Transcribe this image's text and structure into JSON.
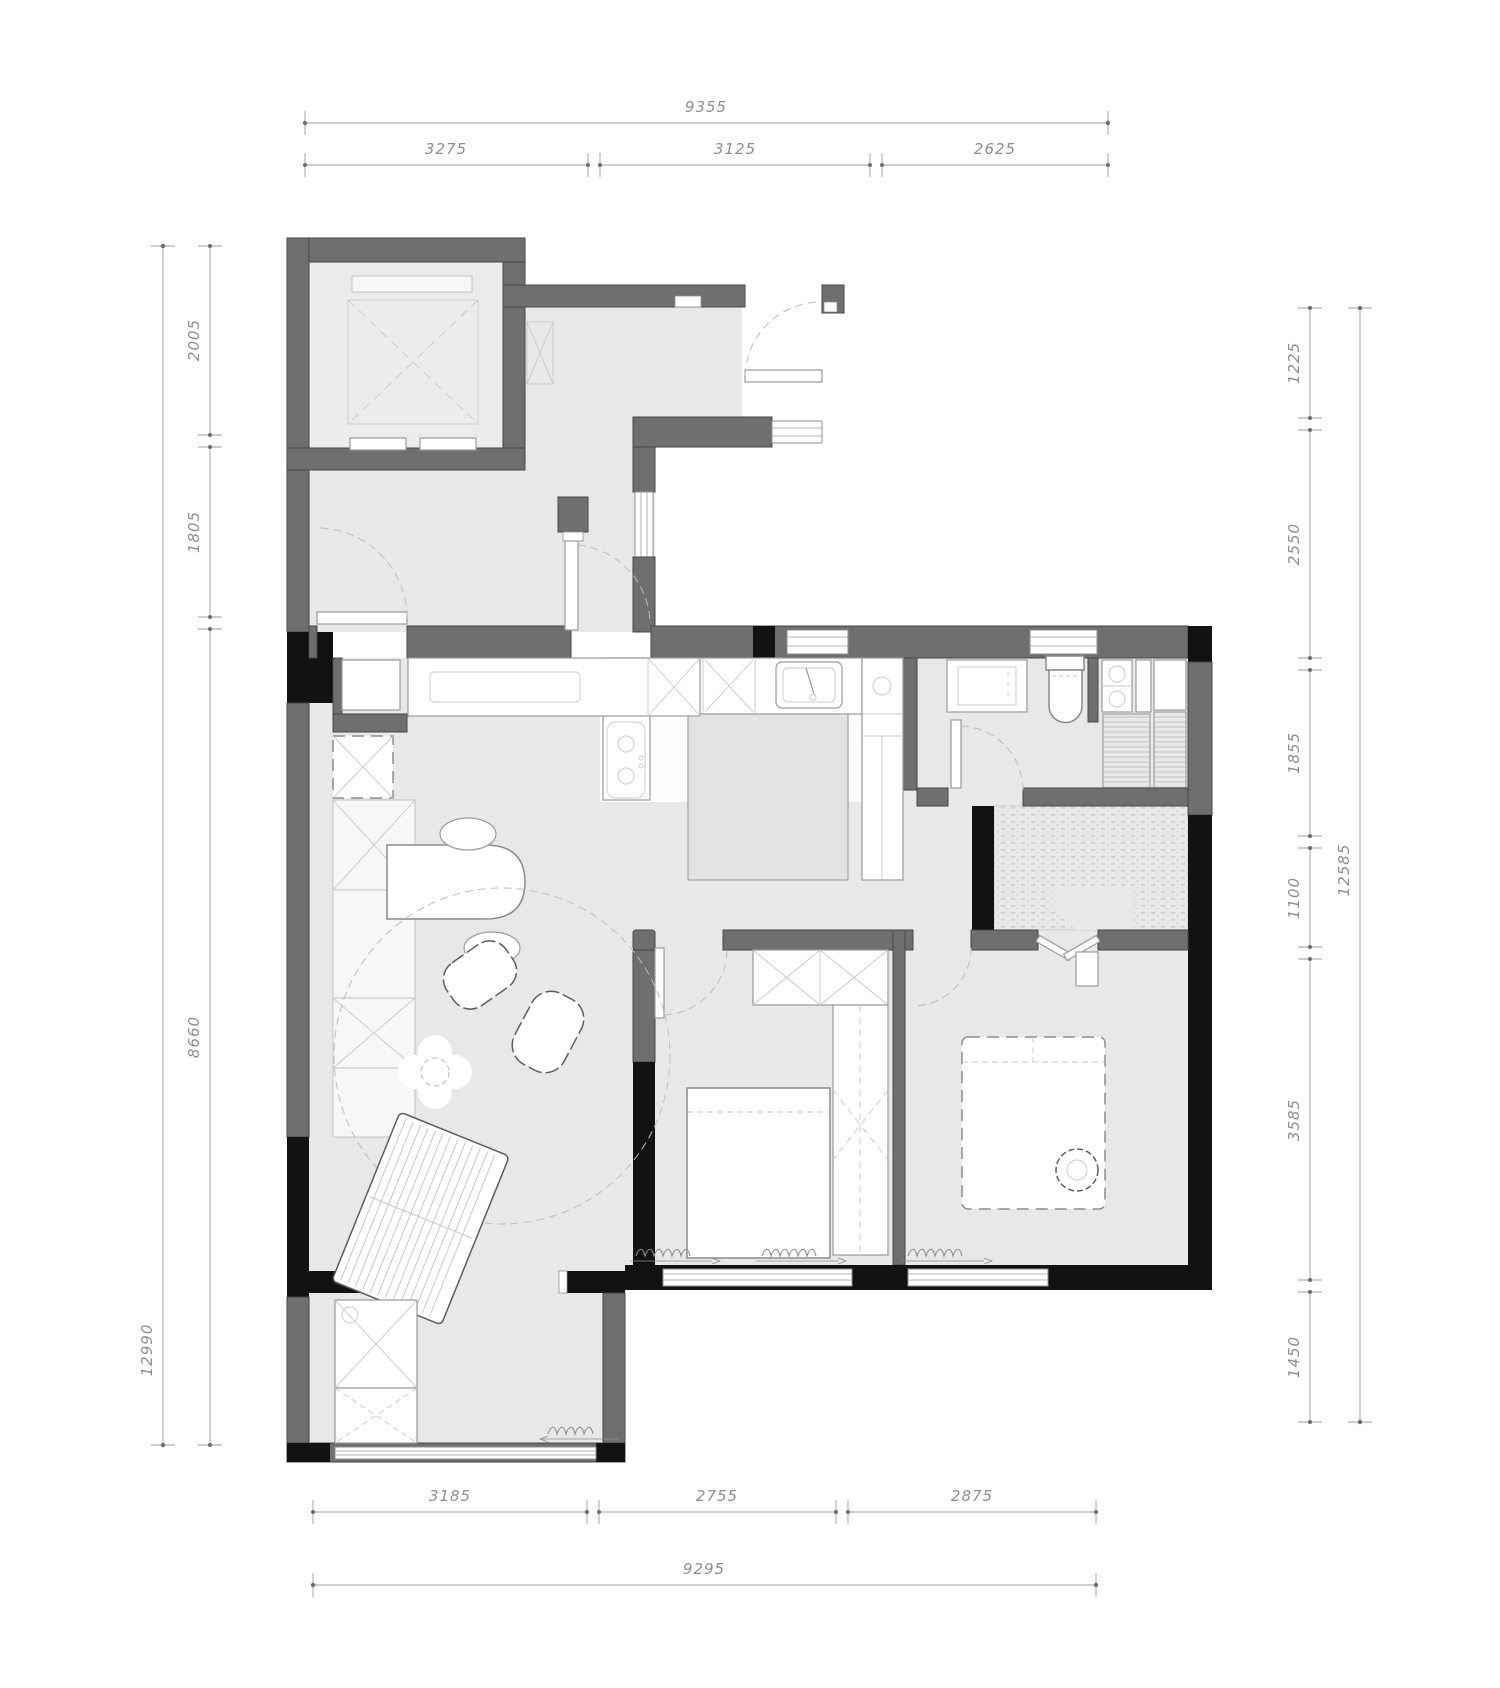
{
  "title": "apartment-floor-plan",
  "colors": {
    "wall": "#6f6f6f",
    "structural_black": "#121212",
    "floor": "#e8e8e8",
    "kitchen_floor": "#fdfdfd",
    "fixture_outline": "#9a9a9a",
    "dimension_text": "#8e8e8e",
    "background": "#ffffff"
  },
  "dimensions": {
    "top": {
      "overall": "9355",
      "segments": [
        "3275",
        "3125",
        "2625"
      ]
    },
    "bottom": {
      "overall": "9295",
      "segments": [
        "3185",
        "2755",
        "2875"
      ]
    },
    "left": {
      "overall": "12990",
      "segments": [
        "2005",
        "1805",
        "8660"
      ]
    },
    "right": {
      "overall": "12585",
      "segments": [
        "1225",
        "2550",
        "1855",
        "1100",
        "3585",
        "1450"
      ]
    }
  }
}
